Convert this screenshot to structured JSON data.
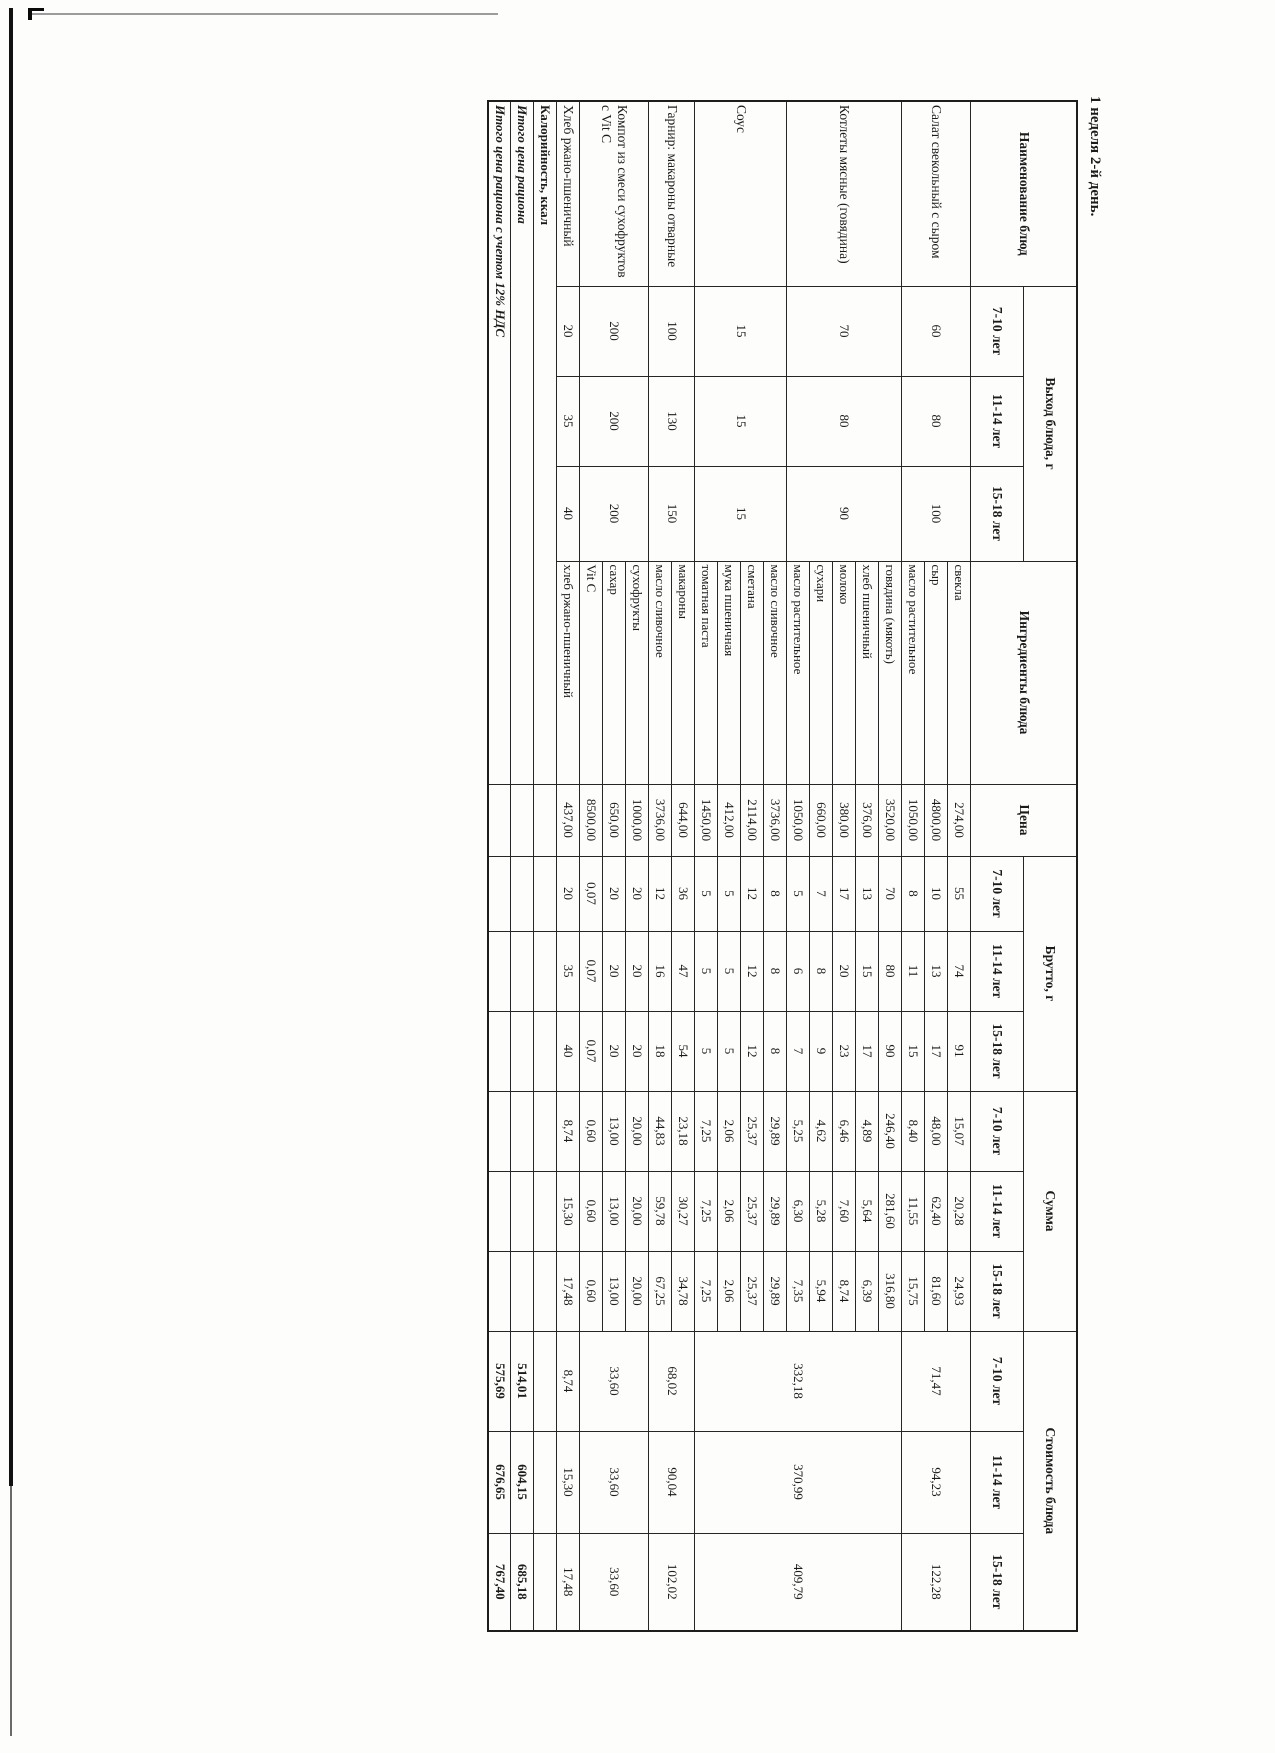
{
  "title": "1 неделя 2-й день.",
  "h": {
    "name": "Наименование блюд",
    "out": "Выход блюда, г",
    "ing": "Ингредиенты блюда",
    "price": "Цена",
    "brutto": "Брутто, г",
    "sum": "Сумма",
    "cost": "Стоимость блюда",
    "a1": "7-10 лет",
    "a2": "11-14 лет",
    "a3": "15-18 лет"
  },
  "dishes": [
    {
      "name": "Салат свекольный с сыром",
      "out": [
        "60",
        "80",
        "100"
      ],
      "cost": [
        "71,47",
        "94,23",
        "122,28"
      ]
    },
    {
      "name": "Котлеты мясные (говядина)",
      "out": [
        "70",
        "80",
        "90"
      ],
      "cost": [
        "332,18",
        "370,99",
        "409,79"
      ]
    },
    {
      "name": "Соус",
      "out": [
        "15",
        "15",
        "15"
      ]
    },
    {
      "name": "Гарнир: макароны отварные",
      "out": [
        "100",
        "130",
        "150"
      ],
      "cost": [
        "68,02",
        "90,04",
        "102,02"
      ]
    },
    {
      "name": "Компот из смеси сухофруктов с Vit C",
      "out": [
        "200",
        "200",
        "200"
      ],
      "cost": [
        "33,60",
        "33,60",
        "33,60"
      ]
    },
    {
      "name": "Хлеб ржано-пшеничный",
      "out": [
        "20",
        "35",
        "40"
      ],
      "cost": [
        "8,74",
        "15,30",
        "17,48"
      ]
    }
  ],
  "rows": [
    {
      "ing": "свекла",
      "price": "274,00",
      "b": [
        "55",
        "74",
        "91"
      ],
      "s": [
        "15,07",
        "20,28",
        "24,93"
      ]
    },
    {
      "ing": "сыр",
      "price": "4800,00",
      "b": [
        "10",
        "13",
        "17"
      ],
      "s": [
        "48,00",
        "62,40",
        "81,60"
      ]
    },
    {
      "ing": "масло растительное",
      "price": "1050,00",
      "b": [
        "8",
        "11",
        "15"
      ],
      "s": [
        "8,40",
        "11,55",
        "15,75"
      ]
    },
    {
      "ing": "говядина (мякоть)",
      "price": "3520,00",
      "b": [
        "70",
        "80",
        "90"
      ],
      "s": [
        "246,40",
        "281,60",
        "316,80"
      ]
    },
    {
      "ing": "хлеб пшеничный",
      "price": "376,00",
      "b": [
        "13",
        "15",
        "17"
      ],
      "s": [
        "4,89",
        "5,64",
        "6,39"
      ]
    },
    {
      "ing": "молоко",
      "price": "380,00",
      "b": [
        "17",
        "20",
        "23"
      ],
      "s": [
        "6,46",
        "7,60",
        "8,74"
      ]
    },
    {
      "ing": "сухари",
      "price": "660,00",
      "b": [
        "7",
        "8",
        "9"
      ],
      "s": [
        "4,62",
        "5,28",
        "5,94"
      ]
    },
    {
      "ing": "масло растительное",
      "price": "1050,00",
      "b": [
        "5",
        "6",
        "7"
      ],
      "s": [
        "5,25",
        "6,30",
        "7,35"
      ]
    },
    {
      "ing": "масло сливочное",
      "price": "3736,00",
      "b": [
        "8",
        "8",
        "8"
      ],
      "s": [
        "29,89",
        "29,89",
        "29,89"
      ]
    },
    {
      "ing": "сметана",
      "price": "2114,00",
      "b": [
        "12",
        "12",
        "12"
      ],
      "s": [
        "25,37",
        "25,37",
        "25,37"
      ]
    },
    {
      "ing": "мука пшеничная",
      "price": "412,00",
      "b": [
        "5",
        "5",
        "5"
      ],
      "s": [
        "2,06",
        "2,06",
        "2,06"
      ]
    },
    {
      "ing": "томатная паста",
      "price": "1450,00",
      "b": [
        "5",
        "5",
        "5"
      ],
      "s": [
        "7,25",
        "7,25",
        "7,25"
      ]
    },
    {
      "ing": "макароны",
      "price": "644,00",
      "b": [
        "36",
        "47",
        "54"
      ],
      "s": [
        "23,18",
        "30,27",
        "34,78"
      ]
    },
    {
      "ing": "масло сливочное",
      "price": "3736,00",
      "b": [
        "12",
        "16",
        "18"
      ],
      "s": [
        "44,83",
        "59,78",
        "67,25"
      ]
    },
    {
      "ing": "сухофрукты",
      "price": "1000,00",
      "b": [
        "20",
        "20",
        "20"
      ],
      "s": [
        "20,00",
        "20,00",
        "20,00"
      ]
    },
    {
      "ing": "сахар",
      "price": "650,00",
      "b": [
        "20",
        "20",
        "20"
      ],
      "s": [
        "13,00",
        "13,00",
        "13,00"
      ]
    },
    {
      "ing": "Vit C",
      "price": "8500,00",
      "b": [
        "0,07",
        "0,07",
        "0,07"
      ],
      "s": [
        "0,60",
        "0,60",
        "0,60"
      ]
    },
    {
      "ing": "хлеб ржано-пшеничный",
      "price": "437,00",
      "b": [
        "20",
        "35",
        "40"
      ],
      "s": [
        "8,74",
        "15,30",
        "17,48"
      ]
    }
  ],
  "footer": {
    "kcal_label": "Калорийность, ккал",
    "total_label": "Итого цена рациона",
    "total_vat_label": "Итого цена рациона с учетом 12% НДС",
    "total": [
      "514,01",
      "604,15",
      "685,18"
    ],
    "total_vat": [
      "575,69",
      "676,65",
      "767,40"
    ]
  }
}
